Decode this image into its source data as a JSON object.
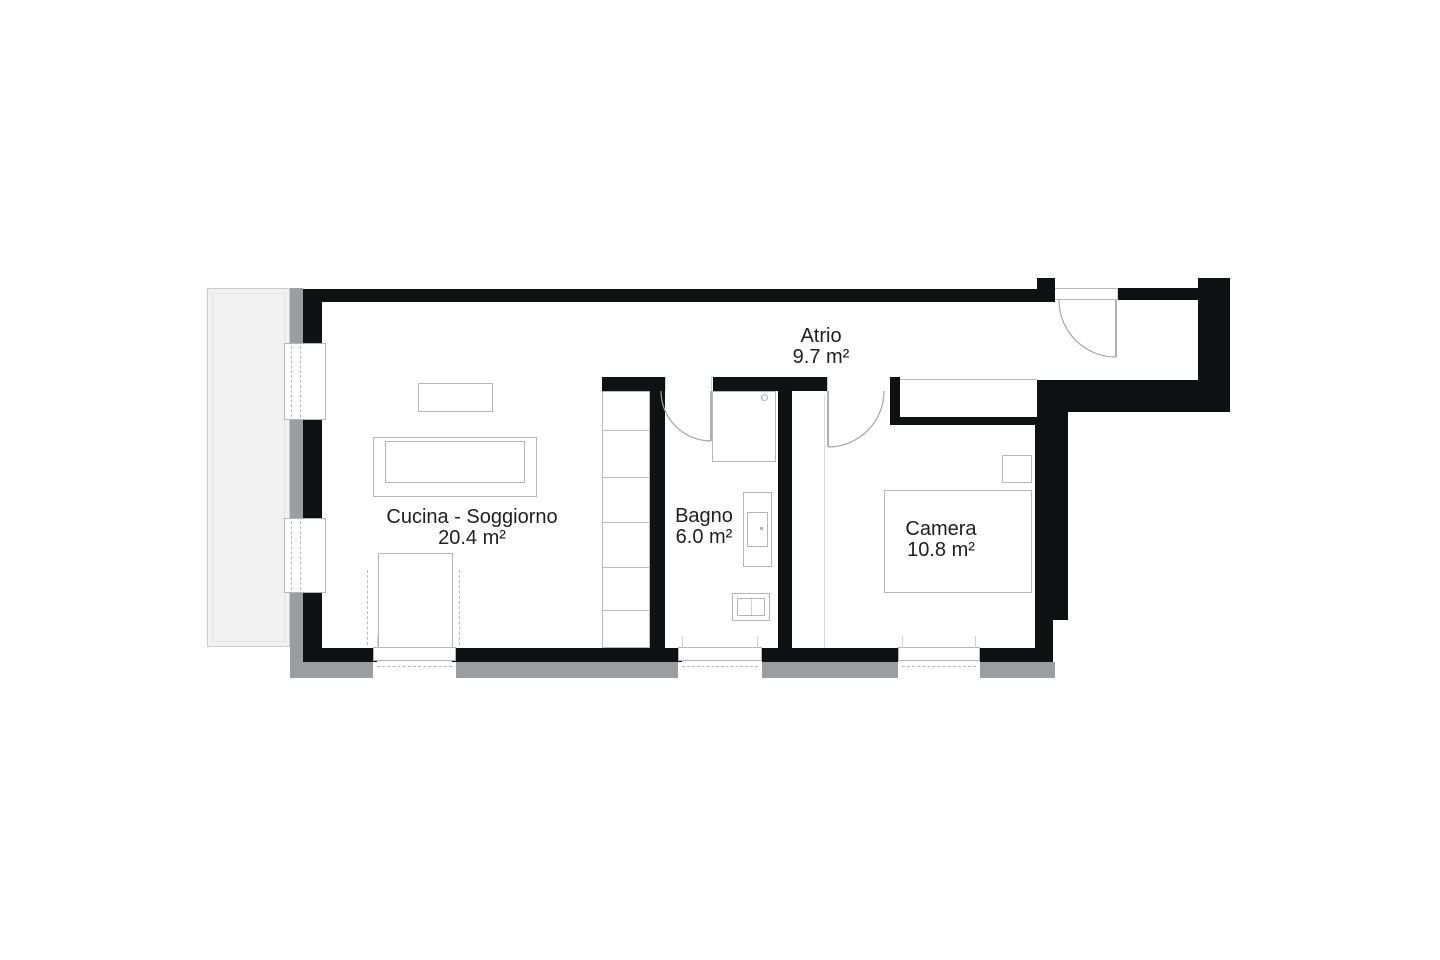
{
  "plan": {
    "title": "apartment-floor-plan",
    "rooms": [
      {
        "name": "Atrio",
        "area": "9.7 m²"
      },
      {
        "name": "Cucina - Soggiorno",
        "area": "20.4 m²"
      },
      {
        "name": "Bagno",
        "area": "6.0 m²"
      },
      {
        "name": "Camera",
        "area": "10.8 m²"
      }
    ],
    "colors": {
      "wall": "#0f1113",
      "outer_band": "#9b9da0",
      "balcony_fill": "#f1f1f2",
      "furniture_line": "#b5b5b5",
      "text": "#202020",
      "background": "#ffffff"
    }
  }
}
